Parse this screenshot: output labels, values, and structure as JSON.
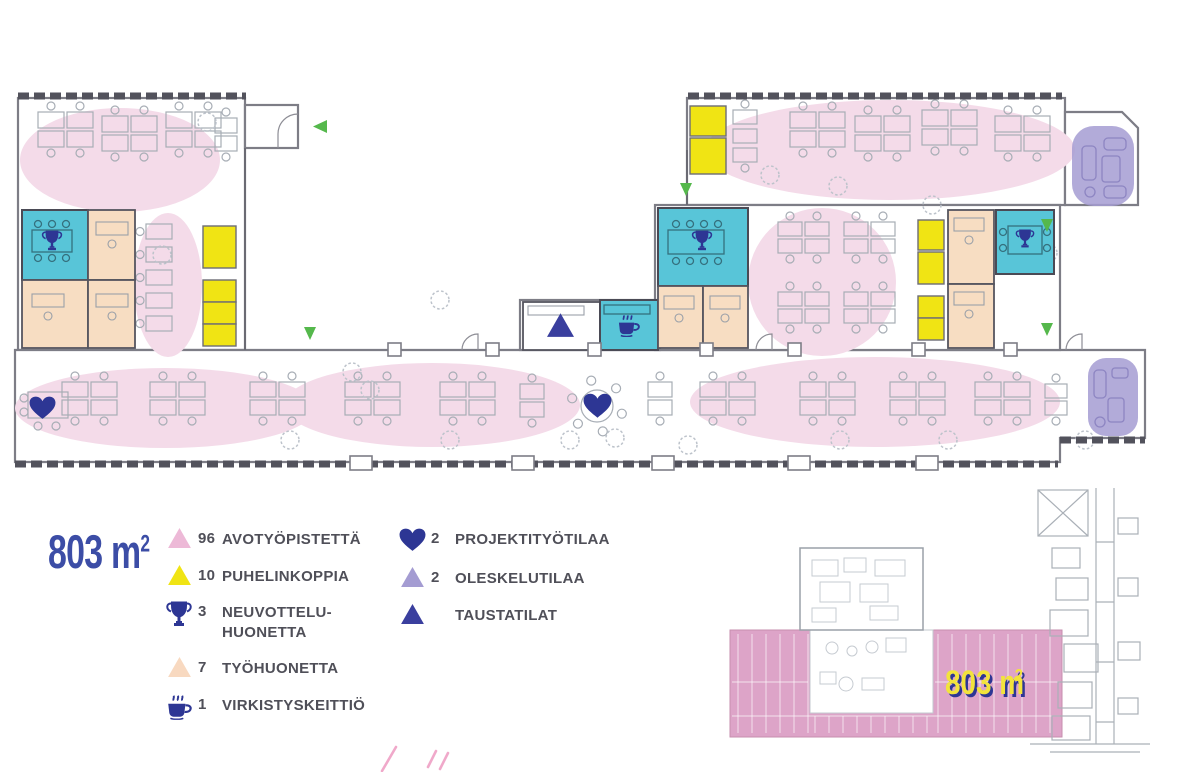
{
  "colors": {
    "navy": "#2d3694",
    "blue_heading": "#3c4da6",
    "legend_text": "#4f4f58",
    "pink_blob": "#f4dbe9",
    "pink_triangle": "#edb9d7",
    "yellow": "#f0e414",
    "peach": "#f7ddc2",
    "peach_triangle": "#f8d9c0",
    "teal": "#58c5d8",
    "purple": "#a49cd2",
    "navy_triangle": "#3a3f9e",
    "green": "#55b84c",
    "wall": "#7d7d86",
    "furniture": "#a7adb5",
    "overview_pink": "#dda4c8",
    "overview_yellow": "#f2e33c"
  },
  "area": {
    "number_unit": "803 m",
    "exponent": "2"
  },
  "legend": {
    "col1": [
      {
        "name": "open-workstations",
        "count": "96",
        "label": "AVOTYÖPISTETTÄ"
      },
      {
        "name": "phone-booths",
        "count": "10",
        "label": "PUHELINKOPPIA"
      },
      {
        "name": "meeting-rooms",
        "count": "3",
        "label": "NEUVOTTELU-\nHUONETTA"
      },
      {
        "name": "work-rooms",
        "count": "7",
        "label": "TYÖHUONETTA"
      },
      {
        "name": "refreshment-kitchen",
        "count": "1",
        "label": "VIRKISTYSKEITTIÖ"
      }
    ],
    "col2": [
      {
        "name": "project-work-spaces",
        "count": "2",
        "label": "PROJEKTITYÖTILAA"
      },
      {
        "name": "lounge-spaces",
        "count": "2",
        "label": "OLESKELUTILAA"
      },
      {
        "name": "support-spaces",
        "count": "",
        "label": "TAUSTATILAT"
      }
    ]
  },
  "overview": {
    "area_number_unit": "803 m",
    "area_exponent": "2"
  }
}
